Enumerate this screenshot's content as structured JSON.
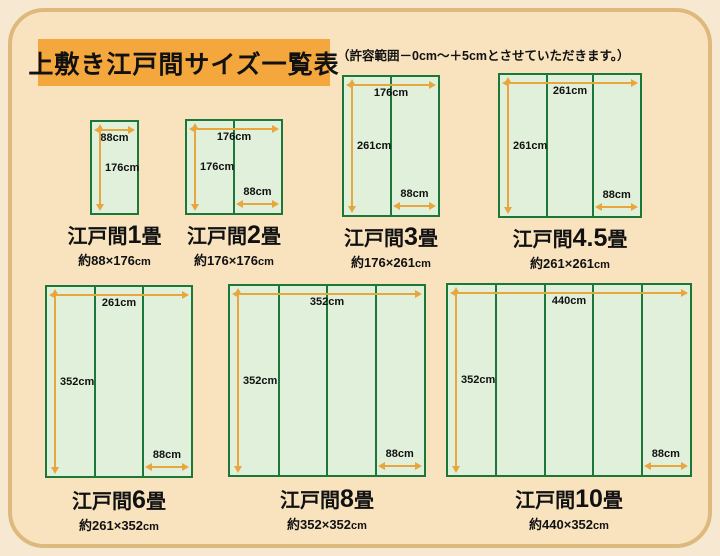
{
  "header": {
    "title": "上敷き江戸間サイズ一覧表",
    "note": "（許容範囲－0cm～＋5cmとさせていただきます。）"
  },
  "colors": {
    "page_outer": "#F7E9D1",
    "page_bg": "#F8E3BE",
    "frame_border": "#DDB97E",
    "title_bg": "#F4A73C",
    "mat_fill": "#E1F0DA",
    "mat_border": "#1C7839",
    "arrow": "#E9A63C",
    "text": "#111111"
  },
  "diagrams": [
    {
      "id": "1jo",
      "name_prefix": "江戸間",
      "name_number": "1",
      "name_suffix": "畳",
      "size_label": "約88×176",
      "size_unit": "cm",
      "width_cm": 88,
      "height_cm": 176,
      "strips": 1,
      "top_label": "88cm",
      "side_label": "176cm",
      "strip_label": null
    },
    {
      "id": "2jo",
      "name_prefix": "江戸間",
      "name_number": "2",
      "name_suffix": "畳",
      "size_label": "約176×176",
      "size_unit": "cm",
      "width_cm": 176,
      "height_cm": 176,
      "strips": 2,
      "top_label": "176cm",
      "side_label": "176cm",
      "strip_label": "88cm"
    },
    {
      "id": "3jo",
      "name_prefix": "江戸間",
      "name_number": "3",
      "name_suffix": "畳",
      "size_label": "約176×261",
      "size_unit": "cm",
      "width_cm": 176,
      "height_cm": 261,
      "strips": 2,
      "top_label": "176cm",
      "side_label": "261cm",
      "strip_label": "88cm"
    },
    {
      "id": "4-5jo",
      "name_prefix": "江戸間",
      "name_number": "4.5",
      "name_suffix": "畳",
      "size_label": "約261×261",
      "size_unit": "cm",
      "width_cm": 261,
      "height_cm": 261,
      "strips": 3,
      "top_label": "261cm",
      "side_label": "261cm",
      "strip_label": "88cm"
    },
    {
      "id": "6jo",
      "name_prefix": "江戸間",
      "name_number": "6",
      "name_suffix": "畳",
      "size_label": "約261×352",
      "size_unit": "cm",
      "width_cm": 261,
      "height_cm": 352,
      "strips": 3,
      "top_label": "261cm",
      "side_label": "352cm",
      "strip_label": "88cm"
    },
    {
      "id": "8jo",
      "name_prefix": "江戸間",
      "name_number": "8",
      "name_suffix": "畳",
      "size_label": "約352×352",
      "size_unit": "cm",
      "width_cm": 352,
      "height_cm": 352,
      "strips": 4,
      "top_label": "352cm",
      "side_label": "352cm",
      "strip_label": "88cm"
    },
    {
      "id": "10jo",
      "name_prefix": "江戸間",
      "name_number": "10",
      "name_suffix": "畳",
      "size_label": "約440×352",
      "size_unit": "cm",
      "width_cm": 440,
      "height_cm": 352,
      "strips": 5,
      "top_label": "440cm",
      "side_label": "352cm",
      "strip_label": "88cm"
    }
  ]
}
